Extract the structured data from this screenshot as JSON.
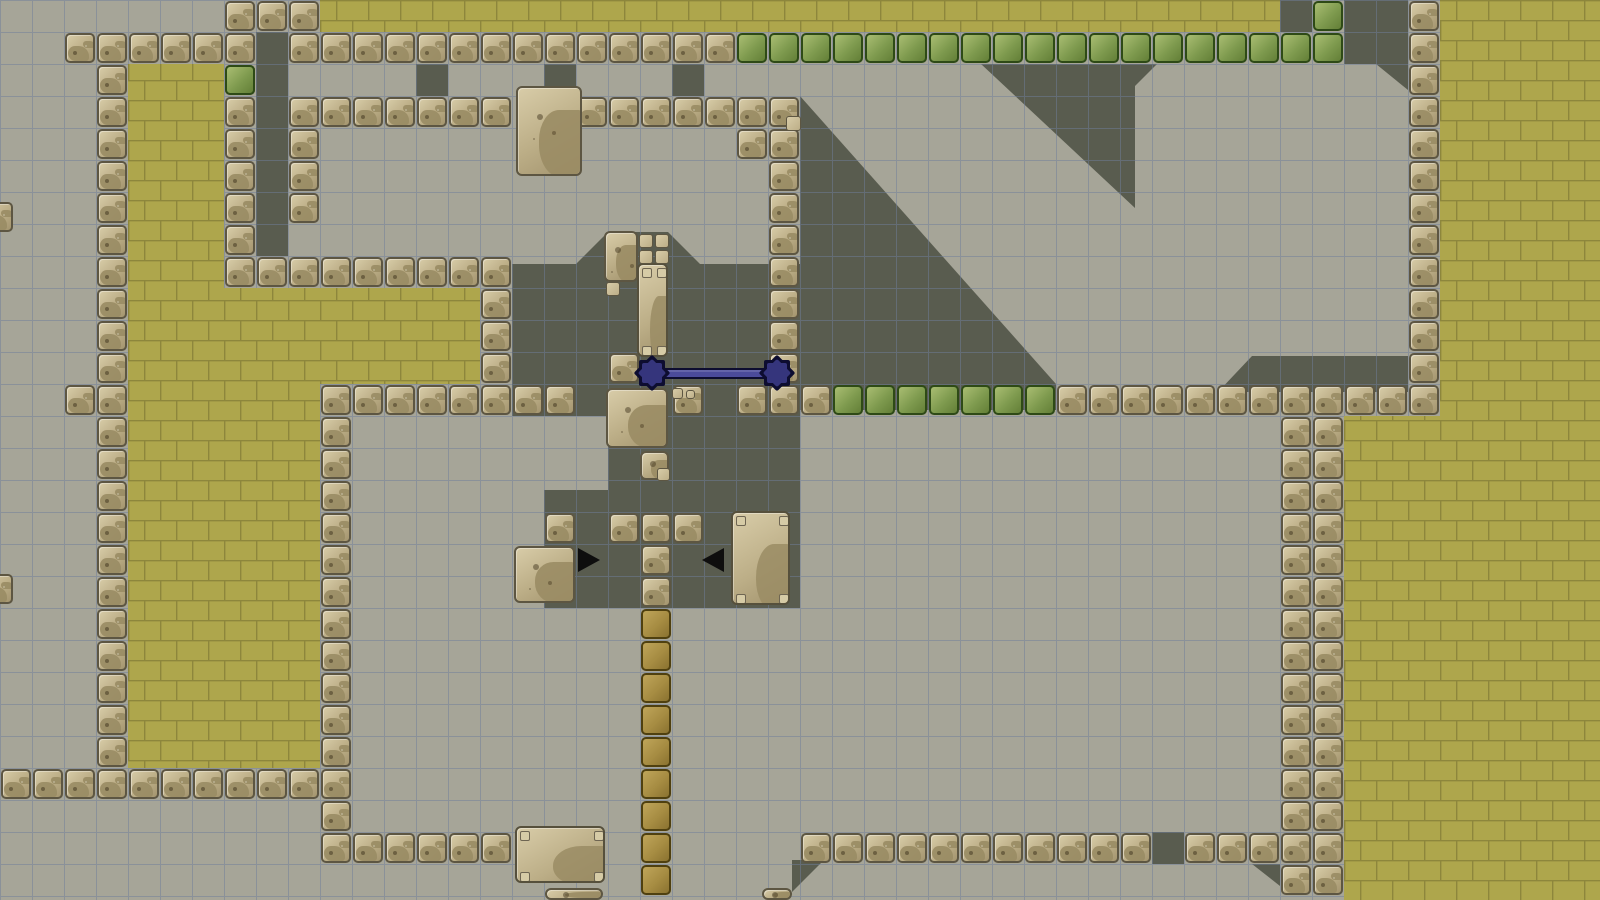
{
  "scene": {
    "description": "side-scrolling tile platformer level viewport",
    "viewport": {
      "width": 1600,
      "height": 900
    },
    "palette": {
      "bg": "#a6a598",
      "shadow": "#595c4f",
      "grid_line": "#6f7f9b",
      "brick_fill": "#aea64c",
      "brick_line": "#8d863c",
      "stone_hi": "#d8cca8",
      "stone_mid": "#bcae87",
      "stone_lo": "#a3946e",
      "stone_edge": "#5d5642",
      "stone_blob": "#9a8c64",
      "green_hi": "#a9bd72",
      "green_mid": "#7e9a4e",
      "green_lo": "#637f37",
      "green_edge": "#2e4a16",
      "green_blob": "#4f6b2c",
      "gold_hi": "#bfa55a",
      "gold_mid": "#a68c42",
      "gold_lo": "#8a7230",
      "gold_edge": "#4f400f",
      "gold_blob": "#796325",
      "panel_edge": "#56503c",
      "rivet": "#d6cba6",
      "rivet_edge": "#6e6552",
      "laser_fill": "#4b4b9b",
      "laser_edge": "#0d0d30",
      "laser_star": "#35357c",
      "arrow": "#0e0e0e"
    },
    "grid": {
      "cell": 32,
      "cols": 50,
      "rows": 28
    },
    "shadows": {
      "cells": [
        [
          8,
          1,
          1,
          7
        ],
        [
          13,
          2,
          1,
          1
        ],
        [
          17,
          2,
          1,
          1
        ],
        [
          21,
          2,
          1,
          1
        ],
        [
          40,
          0,
          1,
          1
        ],
        [
          36,
          26,
          1,
          1
        ]
      ],
      "polys": [
        [
          [
            512,
            264
          ],
          [
            576,
            264
          ],
          [
            608,
            232
          ],
          [
            668,
            232
          ],
          [
            700,
            264
          ],
          [
            800,
            264
          ],
          [
            800,
            608
          ],
          [
            544,
            608
          ],
          [
            544,
            490
          ],
          [
            608,
            490
          ],
          [
            608,
            416
          ],
          [
            512,
            416
          ]
        ],
        [
          [
            981,
            64
          ],
          [
            1157,
            64
          ],
          [
            1135,
            86
          ],
          [
            1135,
            208
          ]
        ],
        [
          [
            800,
            96
          ],
          [
            1056,
            384
          ],
          [
            1056,
            410
          ],
          [
            800,
            410
          ]
        ],
        [
          [
            1252,
            356
          ],
          [
            1408,
            356
          ],
          [
            1408,
            392
          ],
          [
            1218,
            392
          ]
        ],
        [
          [
            1344,
            0
          ],
          [
            1408,
            0
          ],
          [
            1408,
            90
          ],
          [
            1376,
            64
          ],
          [
            1344,
            64
          ]
        ],
        [
          [
            792,
            860
          ],
          [
            824,
            860
          ],
          [
            792,
            892
          ]
        ],
        [
          [
            1252,
            864
          ],
          [
            1280,
            864
          ],
          [
            1280,
            886
          ]
        ]
      ]
    },
    "bricks": {
      "brick_w": 32,
      "brick_h": 20,
      "rects": [
        [
          320,
          0,
          960,
          32
        ],
        [
          1440,
          0,
          160,
          416
        ],
        [
          1344,
          416,
          256,
          484
        ],
        [
          128,
          64,
          96,
          704
        ],
        [
          224,
          288,
          256,
          96
        ],
        [
          224,
          384,
          96,
          384
        ]
      ]
    },
    "tiles": {
      "stone_h": [
        [
          2,
          1,
          6
        ],
        [
          7,
          0,
          3
        ],
        [
          9,
          1,
          14
        ],
        [
          9,
          3,
          7
        ],
        [
          18,
          3,
          7
        ],
        [
          7,
          8,
          9
        ],
        [
          10,
          12,
          8
        ],
        [
          23,
          12,
          3
        ],
        [
          33,
          12,
          12
        ],
        [
          19,
          16,
          3
        ],
        [
          0,
          24,
          10
        ],
        [
          10,
          26,
          6
        ],
        [
          25,
          26,
          11
        ],
        [
          37,
          26,
          3
        ]
      ],
      "stone_v": [
        [
          3,
          2,
          22
        ],
        [
          7,
          1,
          7
        ],
        [
          9,
          4,
          3
        ],
        [
          24,
          4,
          8
        ],
        [
          15,
          9,
          3
        ],
        [
          10,
          13,
          13
        ],
        [
          44,
          0,
          12
        ],
        [
          40,
          13,
          15
        ],
        [
          41,
          13,
          15
        ],
        [
          20,
          16,
          3
        ]
      ],
      "stone_single": [
        [
          23,
          4
        ],
        [
          2,
          12
        ],
        [
          19,
          11
        ],
        [
          21,
          12
        ],
        [
          17,
          16
        ]
      ],
      "green_h": [
        [
          23,
          1,
          19
        ],
        [
          26,
          12,
          7
        ]
      ],
      "green_single": [
        [
          41,
          0
        ],
        [
          7,
          2
        ]
      ],
      "gold_v": [
        [
          20,
          19,
          9
        ]
      ]
    },
    "props": {
      "dirt_blocks": [
        [
          516,
          86,
          66,
          90
        ],
        [
          604,
          231,
          34,
          51
        ],
        [
          606,
          388,
          62,
          60
        ],
        [
          514,
          546,
          61,
          57
        ],
        [
          640,
          451,
          29,
          29
        ],
        [
          545,
          888,
          58,
          12
        ],
        [
          762,
          888,
          30,
          12
        ]
      ],
      "riveted_panels": [
        [
          637,
          263,
          31,
          94
        ],
        [
          731,
          511,
          59,
          94
        ],
        [
          515,
          826,
          90,
          57
        ]
      ],
      "mini_blocks": [
        [
          639,
          234,
          14
        ],
        [
          655,
          234,
          14
        ],
        [
          639,
          250,
          14
        ],
        [
          655,
          250,
          14
        ],
        [
          606,
          282,
          14
        ],
        [
          657,
          468,
          13
        ],
        [
          786,
          116,
          15
        ],
        [
          672,
          388,
          11
        ],
        [
          686,
          390,
          9
        ]
      ],
      "edge_stones": [
        [
          -17,
          202
        ],
        [
          -17,
          574
        ]
      ],
      "arrows": [
        {
          "x": 578,
          "y": 548,
          "dir": "right"
        },
        {
          "x": 702,
          "y": 548,
          "dir": "left"
        }
      ],
      "laser": {
        "x1": 652,
        "x2": 777,
        "y": 373,
        "bar_h": 11,
        "star_r": 13
      }
    }
  }
}
